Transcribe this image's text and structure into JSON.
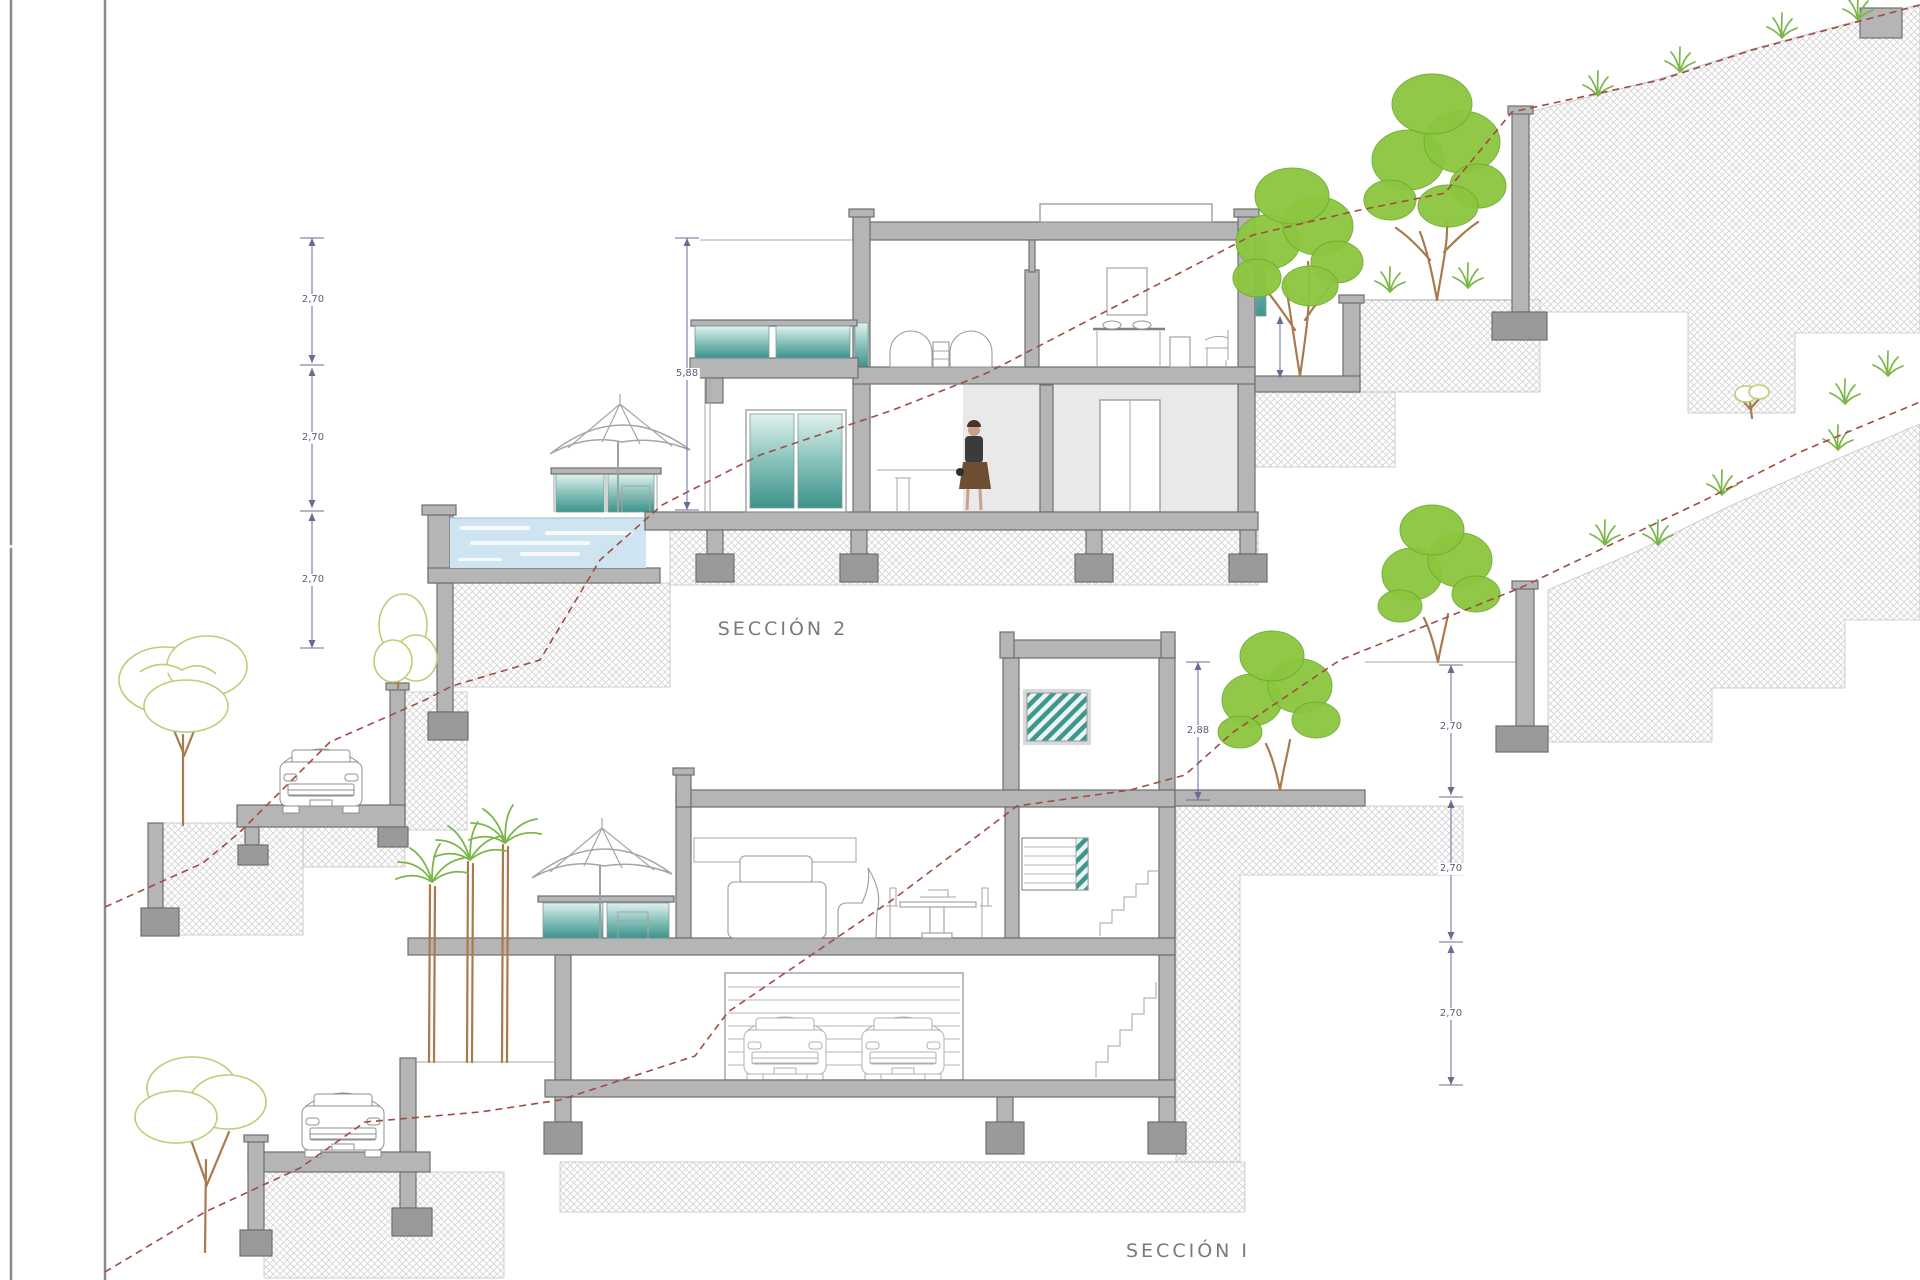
{
  "page": {
    "type": "architectural-section-drawing",
    "background": "#ffffff"
  },
  "labels": {
    "section2": "SECCIÓN 2",
    "section1": "SECCIÓN I"
  },
  "dimensions": {
    "left_stack": [
      "2,70",
      "2,70",
      "2,70"
    ],
    "total_height": "5,88",
    "stair_tower_height": "2,88",
    "right_stack": [
      "2,70",
      "2,70",
      "2,70"
    ]
  },
  "colors": {
    "wall_fill": "#b5b5b5",
    "wall_stroke": "#6f6f6f",
    "hatch": "#d2d2d2",
    "terrain_line": "#a14b44",
    "dim": "#6a6a94",
    "text": "#7a7a7a",
    "tree_green": "#8cc63f",
    "trunk_brown": "#a97a4e",
    "sketch_green": "#b9cf76",
    "water": "#cfe4f1",
    "teal_dark": "#3d938b"
  }
}
